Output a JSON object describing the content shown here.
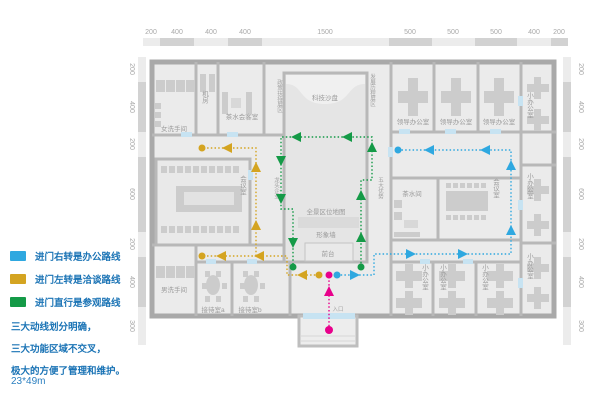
{
  "colors": {
    "office_route": "#2fa8e0",
    "talk_route": "#d4a421",
    "tour_route": "#149a47",
    "entry_route": "#e8008b",
    "text_blue": "#1a73b5"
  },
  "legend": {
    "items": [
      {
        "label": "进门右转是办公路线"
      },
      {
        "label": "进门左转是洽谈路线"
      },
      {
        "label": "进门直行是参观路线"
      }
    ]
  },
  "notes": {
    "line1": "三大动线划分明确，",
    "line2": "三大功能区域不交叉，",
    "line3": "极大的方便了管理和维护。",
    "size": "23*49m"
  },
  "dimensions": {
    "top": [
      "200",
      "400",
      "400",
      "400",
      "1500",
      "500",
      "500",
      "500",
      "400",
      "200"
    ],
    "left": [
      "200",
      "400",
      "200",
      "600",
      "200",
      "400",
      "300"
    ],
    "right": [
      "200",
      "400",
      "200",
      "600",
      "200",
      "400",
      "300"
    ]
  },
  "rooms": {
    "womens_restroom": "女洗手间",
    "machine_room": "机房",
    "tea_reception": "茶水会客室",
    "tech_sandbox": "科技沙盘",
    "policy_wall": "政策扶持展区",
    "history_wall": "发展历程展区",
    "leader_office": "领导办公室",
    "small_office": "小办公室",
    "meeting_room": "会议室",
    "leading_firms": "龙头企业",
    "advantages": "五大优势",
    "location_map": "全景区位地图",
    "image_wall": "形象墙",
    "front_desk": "前台",
    "tea_room": "茶水间",
    "mens_restroom": "男洗手间",
    "reception_a": "接待室a",
    "reception_b": "接待室b",
    "entrance": "入口"
  }
}
